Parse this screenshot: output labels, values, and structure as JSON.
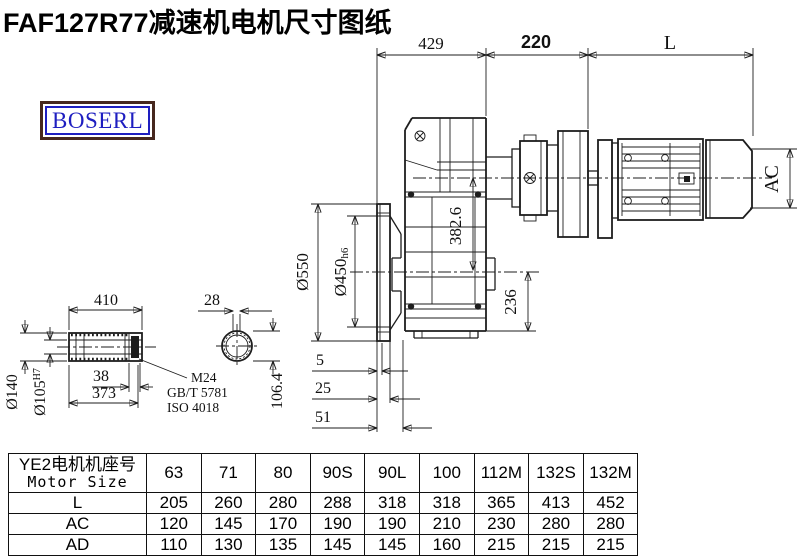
{
  "title": "FAF127R77减速机电机尺寸图纸",
  "logo": "BOSERL",
  "colors": {
    "logo_text": "#1e1ec0",
    "logo_border": "#46281e",
    "line": "#1d1d1d"
  },
  "drawing": {
    "dims": {
      "top_429": "429",
      "top_220": "220",
      "top_L": "L",
      "ac": "AC",
      "d550": "Ø550",
      "d450": "Ø450",
      "d450_tol": "h6",
      "v382": "382.6",
      "v236": "236",
      "f5": "5",
      "f25": "25",
      "f51": "51",
      "shaft_410": "410",
      "shaft_28": "28",
      "d140": "Ø140",
      "d105": "Ø105",
      "d105_tol": "H7",
      "shaft_38": "38",
      "shaft_373": "373",
      "v106": "106.4",
      "note_m24": "M24",
      "note_gbt": "GB/T 5781",
      "note_iso": "ISO 4018"
    }
  },
  "table": {
    "header_cn": "YE2电机机座号",
    "header_en": "Motor Size",
    "sizes": [
      "63",
      "71",
      "80",
      "90S",
      "90L",
      "100",
      "112M",
      "132S",
      "132M"
    ],
    "rows": [
      {
        "label": "L",
        "values": [
          "205",
          "260",
          "280",
          "288",
          "318",
          "318",
          "365",
          "413",
          "452"
        ]
      },
      {
        "label": "AC",
        "values": [
          "120",
          "145",
          "170",
          "190",
          "190",
          "210",
          "230",
          "280",
          "280"
        ]
      },
      {
        "label": "AD",
        "values": [
          "110",
          "130",
          "135",
          "145",
          "145",
          "160",
          "215",
          "215",
          "215"
        ]
      }
    ]
  }
}
